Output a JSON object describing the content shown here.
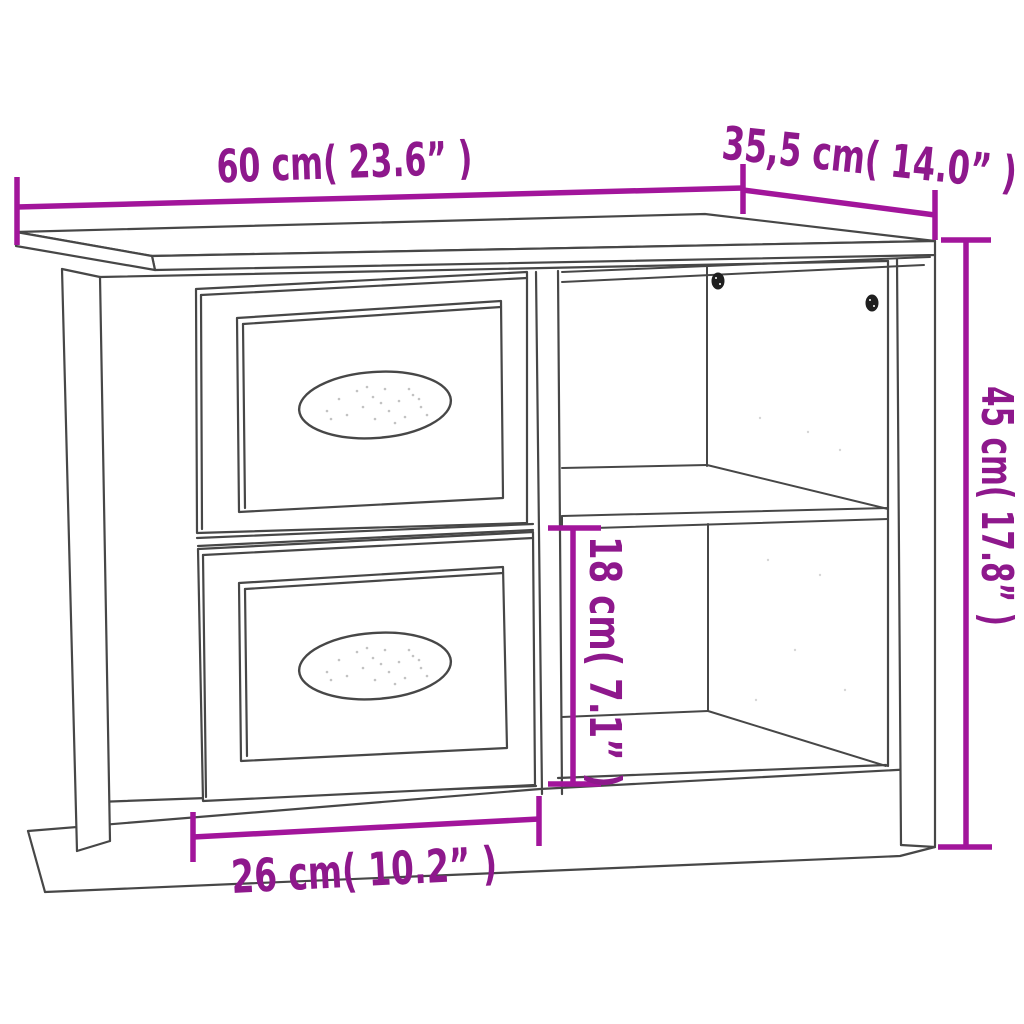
{
  "figure": {
    "description": "Line drawing of a bedside cabinet with two drawers on the left and an open two-compartment shelf section on the right, annotated with product dimensions"
  },
  "colors": {
    "dimension_text": "#8E188C",
    "dimension_line": "#A2159B",
    "line_art": "#474747",
    "screw": "#1F1F1F",
    "background": "#FFFFFF"
  },
  "dimensions": {
    "width": {
      "label": "60 cm( 23.6” )"
    },
    "depth": {
      "label": "35,5 cm( 14.0” )"
    },
    "height": {
      "label": "45 cm( 17.8” )"
    },
    "compartment_height": {
      "label": "18 cm( 7.1” )"
    },
    "base_width": {
      "label": "26 cm( 10.2” )"
    }
  }
}
